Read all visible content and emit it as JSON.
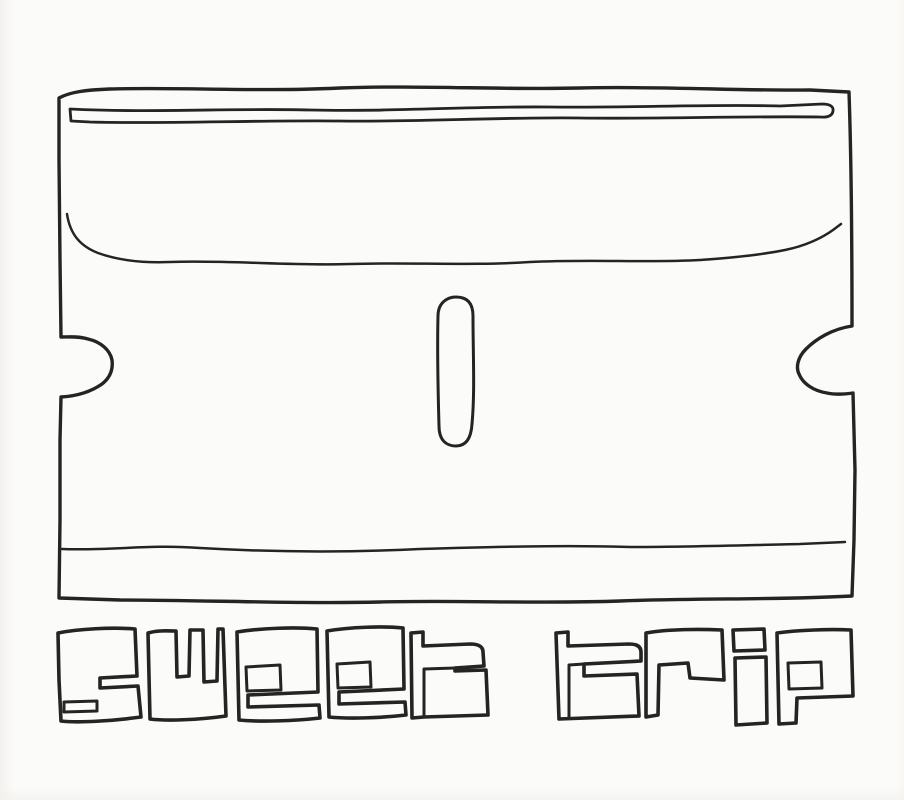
{
  "artwork": {
    "caption": "sweet trip",
    "words": [
      {
        "text": "sweet"
      },
      {
        "text": "trip"
      }
    ],
    "subject_icon": "razor-blade",
    "colors": {
      "ink": "#242424",
      "paper": "#fbfbf9"
    }
  }
}
